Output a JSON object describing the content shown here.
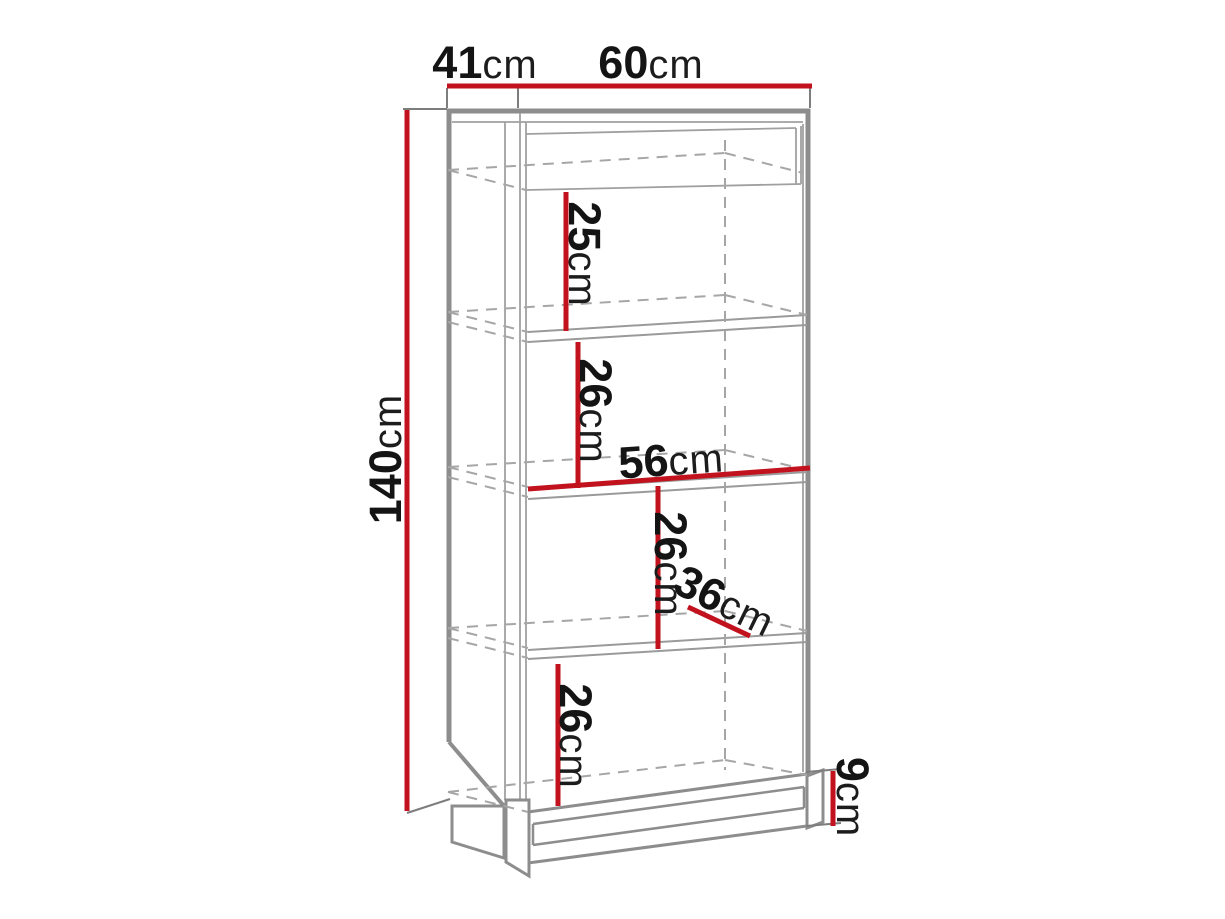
{
  "diagram": {
    "title": "furniture technical dimension drawing",
    "subject": "tall open bookcase / cabinet with four shelves and recessed plinth base",
    "units": "cm",
    "colors": {
      "background": "#ffffff",
      "dimension_line": "#c2121e",
      "structure_line": "#8d8d8d",
      "hidden_edge_line": "#a6a6a6",
      "label_text": "#141414"
    },
    "dims": {
      "top_depth": {
        "value": "41",
        "unit": "cm",
        "meaning": "overall depth (top view, left segment)"
      },
      "top_width": {
        "value": "60",
        "unit": "cm",
        "meaning": "overall width (top segment)"
      },
      "height": {
        "value": "140",
        "unit": "cm",
        "meaning": "overall height (left vertical)"
      },
      "section1": {
        "value": "25",
        "unit": "cm",
        "meaning": "first compartment height"
      },
      "section2": {
        "value": "26",
        "unit": "cm",
        "meaning": "second compartment height"
      },
      "inner_width": {
        "value": "56",
        "unit": "cm",
        "meaning": "interior shelf width"
      },
      "section3": {
        "value": "26",
        "unit": "cm",
        "meaning": "third compartment height"
      },
      "inner_depth": {
        "value": "36",
        "unit": "cm",
        "meaning": "interior shelf depth"
      },
      "section4": {
        "value": "26",
        "unit": "cm",
        "meaning": "fourth compartment height"
      },
      "base_height": {
        "value": "9",
        "unit": "cm",
        "meaning": "plinth / base height"
      }
    }
  }
}
